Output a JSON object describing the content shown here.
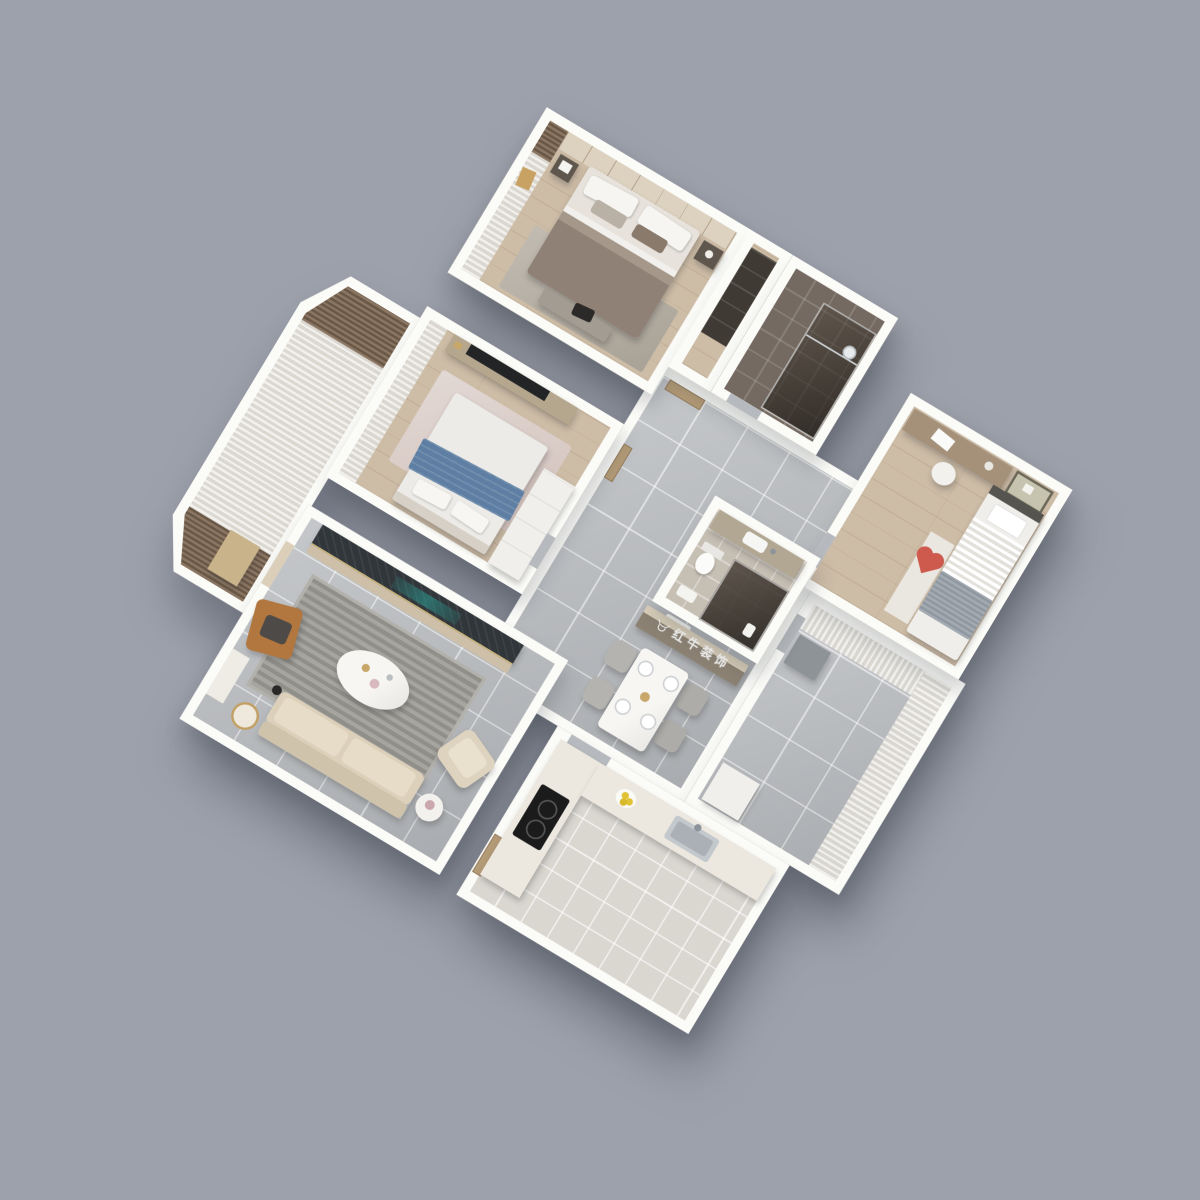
{
  "scene": {
    "type": "3d-isometric-apartment-floor-plan",
    "view": "axonometric top-down render rotated ~31 degrees on plain gray backdrop",
    "watermark": {
      "text": "红牛装饰",
      "logo": "bull-logo-icon",
      "color": "rgba(255,255,255,0.85)"
    },
    "palette": {
      "background": "#9da1ab",
      "walls": "#fbfbf8",
      "wood_floor": "#cdbca6",
      "gray_tile_floor": "#b6b9bd",
      "dark_bath_tile": "#746a61",
      "kitchen_tile": "#dad7d1",
      "sofa_beige": "#dcd0bb",
      "media_wall_marble": "#31363a",
      "fireplace_glow_teal": "#2aa096",
      "throw_blue": "#5e7fa3",
      "heart_red": "#cd5a4d",
      "leather_tan": "#b1773f",
      "door_wood": "#b49b77",
      "cooktop_black": "#1b1b1b",
      "lemon_yellow": "#e0c232"
    },
    "rooms": [
      {
        "id": "master-bedroom",
        "label": "Master Bedroom",
        "floor": "wood",
        "furniture": [
          "double-bed",
          "paneled-headboard-wall",
          "sheer-curtains",
          "brown-drape",
          "nightstands",
          "bench-with-bag",
          "area-rug"
        ]
      },
      {
        "id": "ensuite-bathroom",
        "label": "Ensuite Bathroom",
        "floor": "dark-tile",
        "furniture": [
          "glass-shower",
          "rain-shower-head"
        ]
      },
      {
        "id": "wardrobe-niche",
        "label": "Wardrobe Niche",
        "floor": "wood",
        "furniture": [
          "dark-wardrobe"
        ]
      },
      {
        "id": "kids-bedroom",
        "label": "Kids Bedroom",
        "floor": "wood",
        "furniture": [
          "single-bed",
          "gray-blanket",
          "desk",
          "chair",
          "wall-art",
          "side-shelf",
          "heart-pillow"
        ]
      },
      {
        "id": "second-bedroom",
        "label": "Second Bedroom",
        "floor": "wood",
        "furniture": [
          "double-bed",
          "blue-throw",
          "wall-tv",
          "media-console",
          "sheer-curtains",
          "white-wardrobe",
          "pink-rug"
        ]
      },
      {
        "id": "hallway-dining",
        "label": "Hallway & Dining",
        "floor": "gray-tile",
        "furniture": [
          "entry-door",
          "bedroom-door",
          "sideboard-with-watermark",
          "dining-table",
          "four-chairs",
          "place-settings",
          "door-mat"
        ]
      },
      {
        "id": "main-bathroom",
        "label": "Bathroom",
        "floor": "beige-tile",
        "furniture": [
          "vanity-sink",
          "toilet",
          "dark-glass-shower",
          "bath-mat"
        ]
      },
      {
        "id": "living-room",
        "label": "Living Room",
        "floor": "gray-tile",
        "furniture": [
          "marble-media-wall",
          "fireplace-glow",
          "striped-rug",
          "oval-coffee-table",
          "beige-sofa",
          "armchair",
          "leather-lounge-chair",
          "clothes",
          "floor-lamp",
          "console-desk",
          "gold-tray-table",
          "side-table"
        ]
      },
      {
        "id": "living-balcony",
        "label": "Balcony",
        "floor": "light-wood",
        "furniture": [
          "sheer-curtain-wall",
          "brown-drapes",
          "storage-cabinet"
        ]
      },
      {
        "id": "service-balcony",
        "label": "Service Balcony",
        "floor": "gray-tile",
        "furniture": [
          "sheer-curtains",
          "drying-unit",
          "cabinet"
        ]
      },
      {
        "id": "kitchen",
        "label": "Kitchen",
        "floor": "kitchen-tile",
        "furniture": [
          "l-shaped-counter",
          "black-cooktop",
          "stainless-sink",
          "lemons",
          "wood-door"
        ]
      }
    ]
  }
}
